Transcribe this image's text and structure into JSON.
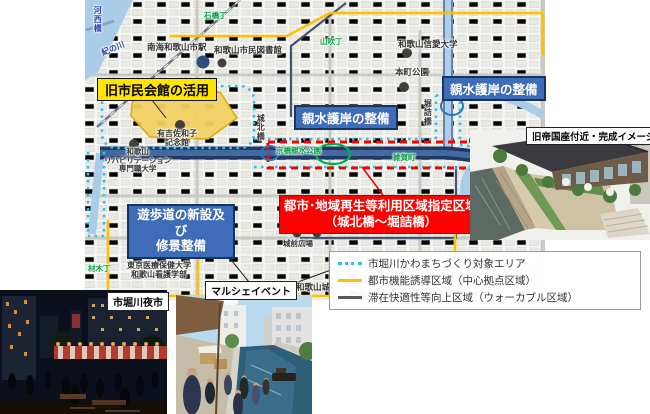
{
  "colors": {
    "accent_red": "#ff0000",
    "label_blue": "#3e6cb8",
    "label_yellow": "#ffe500",
    "legend_cyan": "#2fc0f0",
    "legend_yellow": "#ffc000",
    "legend_gray": "#595959",
    "river_navy": "#1f3864",
    "river_light": "#a9cce8"
  },
  "map": {
    "callouts": {
      "old_hall": "旧市民会館の活用",
      "waterfront_left": "親水護岸の整備",
      "waterfront_right": "親水護岸の整備",
      "promenade_l1": "遊歩道の新設及び",
      "promenade_l2": "修景整備",
      "zone_l1": "都市･地域再生等利用区域指定区域",
      "zone_l2": "（城北橋～堀詰橋）"
    },
    "labels": {
      "kawanishi_bridge": "河西橋",
      "kinokawa": "紀の川",
      "ishibashi_cho": "石橋丁",
      "nankai_station": "南海和歌山市駅",
      "city_library": "和歌山市民図書館",
      "yamabuki_cho": "山吹丁",
      "shinai_univ": "和歌山信愛大学",
      "honmachi_park": "本町公園",
      "horizume_bridge": "堀詰橋",
      "johoku_bridge": "城北橋",
      "ariyoshi_l1": "有吉佐和子",
      "ariyoshi_l2": "記念館",
      "rehab_l1": "和歌山",
      "rehab_l2": "リハビリテーション",
      "rehab_l3": "専門職大学",
      "keyaki_st": "けやき大通り",
      "tokyo_med_l1": "東京医療保健大学",
      "tokyo_med_l2": "和歌山看護学部",
      "kyobashi_park": "京橋親水公園",
      "saika_cho": "雑賀町",
      "zaimoku_cho": "材木丁",
      "jomae_plaza": "城前広場",
      "castle_hall": "和歌山城ホール",
      "castle": "和歌山城"
    }
  },
  "legend": {
    "items": [
      {
        "label": "市堀川かわまちづくり対象エリア",
        "marker": "dotted-cyan"
      },
      {
        "label": "都市機能誘導区域（中心拠点区域）",
        "marker": "solid-yellow"
      },
      {
        "label": "滞在快適性等向上区域（ウォーカブル区域）",
        "marker": "solid-gray"
      }
    ]
  },
  "photos": {
    "render_caption": "旧帝国座付近・完成イメージ",
    "marche_caption": "マルシェイベント",
    "night_caption": "市堀川夜市"
  }
}
